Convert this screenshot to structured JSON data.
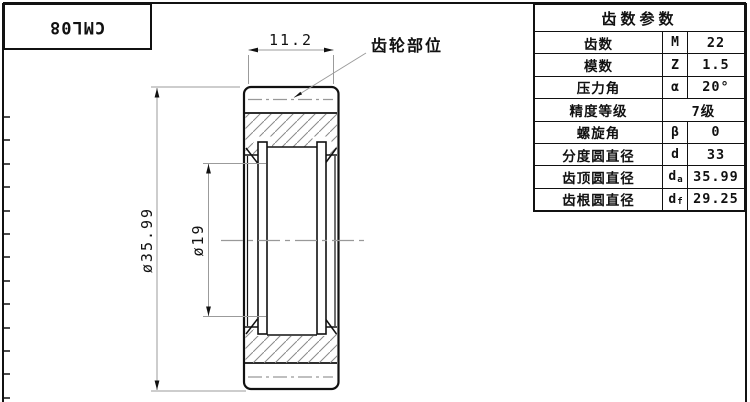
{
  "title_block": {
    "code": "CML08"
  },
  "drawing": {
    "dim_width": "11.2",
    "dim_outer_diameter": "ø35.99",
    "dim_bore_diameter": "ø19",
    "leader_label": "齿轮部位"
  },
  "table": {
    "header": "齿数参数",
    "rows": [
      {
        "label": "齿数",
        "sym": "M",
        "sub": "",
        "value": "22"
      },
      {
        "label": "模数",
        "sym": "Z",
        "sub": "",
        "value": "1.5"
      },
      {
        "label": "压力角",
        "sym": "α",
        "sub": "",
        "value": "20°"
      },
      {
        "label": "精度等级",
        "sym": "",
        "sub": "",
        "value": "7级"
      },
      {
        "label": "螺旋角",
        "sym": "β",
        "sub": "",
        "value": "0"
      },
      {
        "label": "分度圆直径",
        "sym": "d",
        "sub": "",
        "value": "33"
      },
      {
        "label": "齿顶圆直径",
        "sym": "d",
        "sub": "a",
        "value": "35.99"
      },
      {
        "label": "齿根圆直径",
        "sym": "d",
        "sub": "f",
        "value": "29.25"
      }
    ]
  },
  "colors": {
    "outline": "#111111",
    "hatch": "#8a8a8a",
    "dimension": "#9b9b9b",
    "centerline": "#999999",
    "background": "#ffffff"
  }
}
